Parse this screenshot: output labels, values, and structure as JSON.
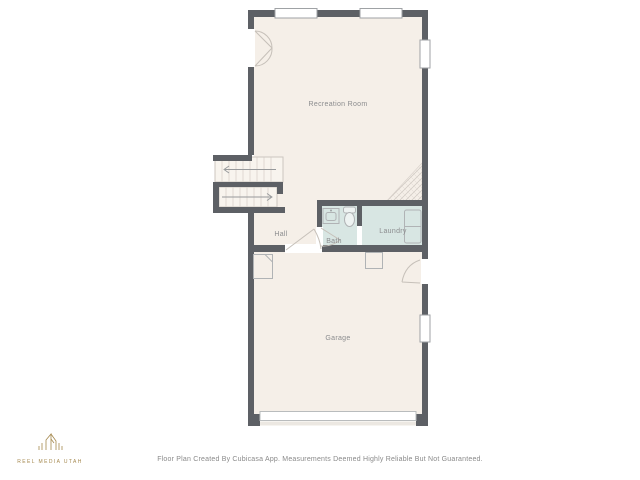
{
  "canvas": {
    "width": 640,
    "height": 480,
    "background": "#ffffff"
  },
  "floor_plan": {
    "rooms": [
      {
        "label": "Recreation Room"
      },
      {
        "label": "Hall"
      },
      {
        "label": "Bath"
      },
      {
        "label": "Laundry"
      },
      {
        "label": "Garage"
      }
    ],
    "colors": {
      "wall": "#5d6065",
      "floor": "#f5efe8",
      "wet_room_floor": "#d8e6e3",
      "stair_fill": "#f8f4ee",
      "fixture_outline": "#b0b3b5",
      "door_arc_line": "#c6c0b9",
      "hatch_line": "#cfc8c1",
      "label_text": "#8b8c8e"
    },
    "fixture_icons": [
      "stairs-up-flight-icon",
      "stairs-down-flight-icon",
      "double-door-icon",
      "interior-door-icon",
      "window-icon",
      "bathroom-sink-icon",
      "toilet-icon",
      "washer-dryer-icon",
      "water-heater-icon",
      "furnace-icon",
      "garage-door-icon",
      "open-below-hatch-icon"
    ]
  },
  "branding": {
    "logo_text": "REEL MEDIA UTAH",
    "logo_color": "#a5894f",
    "logo_icon": "house-outline-icon"
  },
  "footer": {
    "disclaimer": "Floor Plan Created By Cubicasa App. Measurements Deemed Highly Reliable But Not Guaranteed."
  }
}
